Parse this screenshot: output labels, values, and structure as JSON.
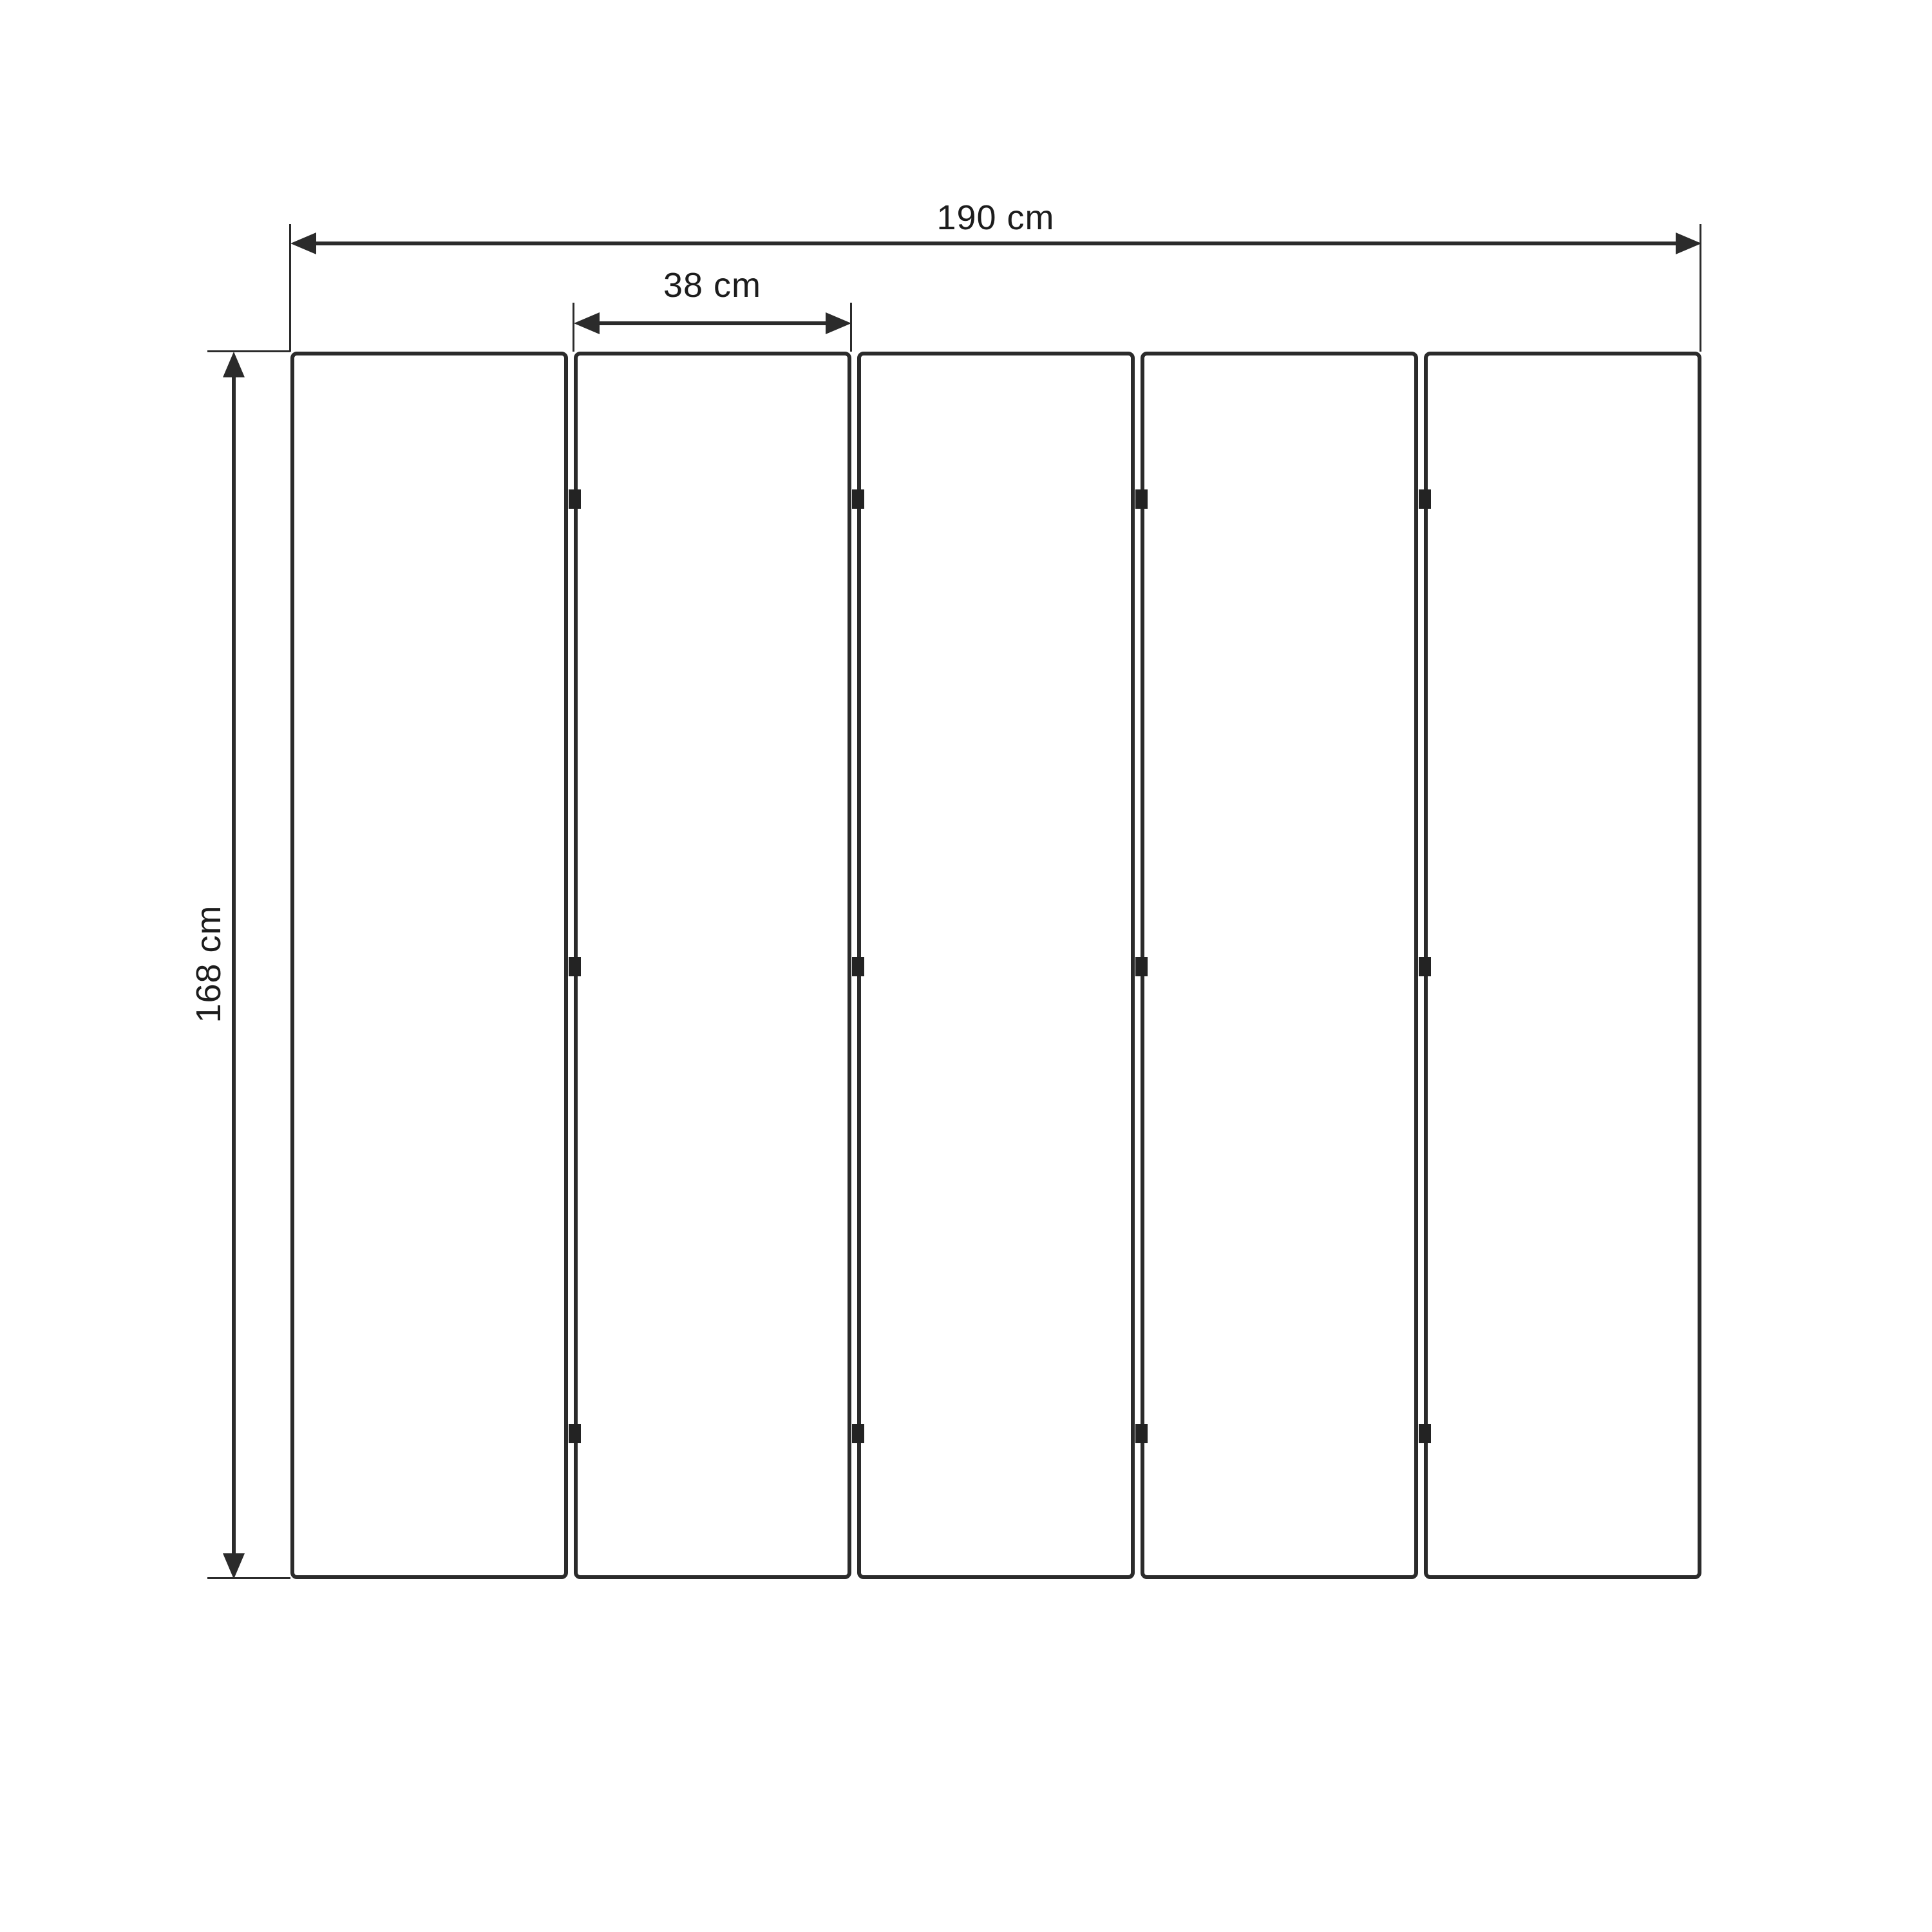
{
  "diagram": {
    "type": "folding-screen-dimension-drawing",
    "labels": {
      "total_width": "190 cm",
      "single_panel_width": "38 cm",
      "height": "168 cm"
    },
    "panels": {
      "count": 5,
      "hinges_per_gap": 3
    },
    "colors": {
      "line": "#2b2b2b",
      "hinge": "#232323",
      "text": "#1c1c1c",
      "background": "#ffffff"
    }
  }
}
